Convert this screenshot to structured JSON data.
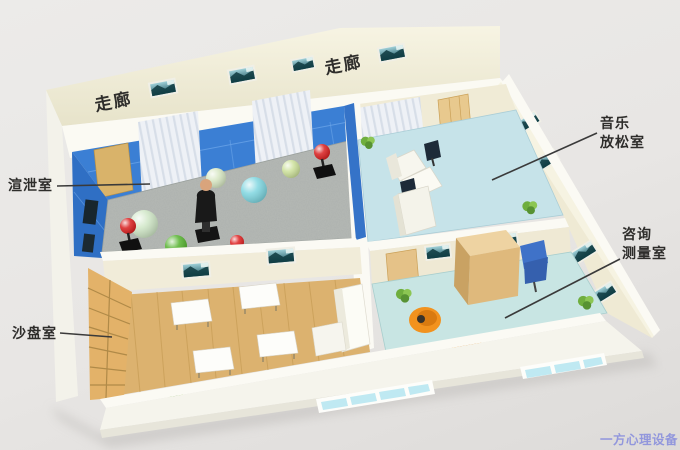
{
  "scene": {
    "description": "3D isometric rendering of a psychology counseling suite floor plan",
    "background_color": "#e8e6e4"
  },
  "corridor": {
    "label_left": "走廊",
    "label_right": "走廊"
  },
  "rooms": {
    "venting": {
      "label": "渲泄室",
      "floor_color": "#b6bab6",
      "wall_color": "#3b7fd4"
    },
    "sand": {
      "label": "沙盘室",
      "floor_color": "#dcb26f"
    },
    "music": {
      "lines": [
        "音乐",
        "放松室"
      ],
      "floor_color": "#c6e3e9"
    },
    "consult": {
      "lines": [
        "咨询",
        "测量室"
      ],
      "floor_color": "#c8e5e3"
    }
  },
  "watermark": {
    "text": "一方心理设备qgng.com",
    "color": "#8a90dd"
  },
  "colors": {
    "corridor_wall": "#f1eedd",
    "interior_wall": "#f0ebd6",
    "white_wall_top": "#fbfaf4",
    "orange_chair": "#f2921e",
    "blue_chair": "#3f72c8",
    "desk_wood": "#e5bc80",
    "label_text": "#2e2d2b",
    "leader_line": "#3a3a3a"
  }
}
